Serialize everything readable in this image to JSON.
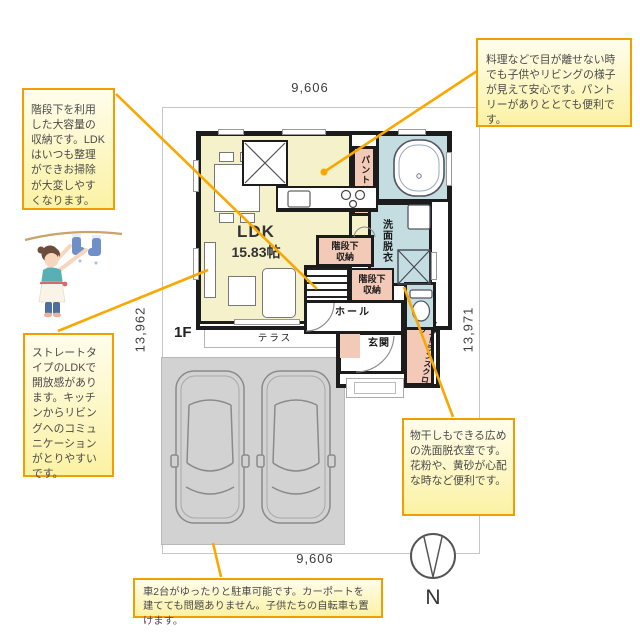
{
  "colors": {
    "accent_orange": "#f09e00",
    "leader_orange": "#f8a800",
    "ldk_yellow": "#f5f1cb",
    "room_pink": "#f3cab8",
    "room_blue": "#c3dde1",
    "parking_gray": "#d2d2d2",
    "wall_black": "#1c1c1c"
  },
  "dimensions": {
    "top": "9,606",
    "bottom": "9,606",
    "left": "13,962",
    "right": "13,971"
  },
  "floor_plan": {
    "floor_label": "1F",
    "rooms": {
      "ldk_name": "LDK",
      "ldk_size": "15.83帖",
      "pantry": "パントリー",
      "washroom": "洗面脱衣",
      "stair_storage_a": "階段下\n収納",
      "stair_storage_b": "階段下\n収納",
      "hall": "ホール",
      "entrance": "玄関",
      "entrance_closet": "エントランスクローク",
      "terrace": "テラス"
    }
  },
  "annotations": {
    "stair_storage": "階段下を利用した大容量の収納です。LDKはいつも整理ができお掃除が大変しやすくなります。",
    "kitchen": "料理などで目が離せない時でも子供やリビングの様子が見えて安心です。パントリーがありととても便利です。",
    "ldk": "ストレートタイプのLDKで開放感があります。キッチンからリビングへのコミュニケーションがとりやすいです。",
    "washroom": "物干しもできる広めの洗面脱衣室です。花粉や、黄砂が心配な時など便利です。",
    "parking": "車2台がゆったりと駐車可能です。カーポートを建てても問題ありません。子供たちの自転車も置けます。"
  },
  "compass": {
    "north_label": "N"
  }
}
